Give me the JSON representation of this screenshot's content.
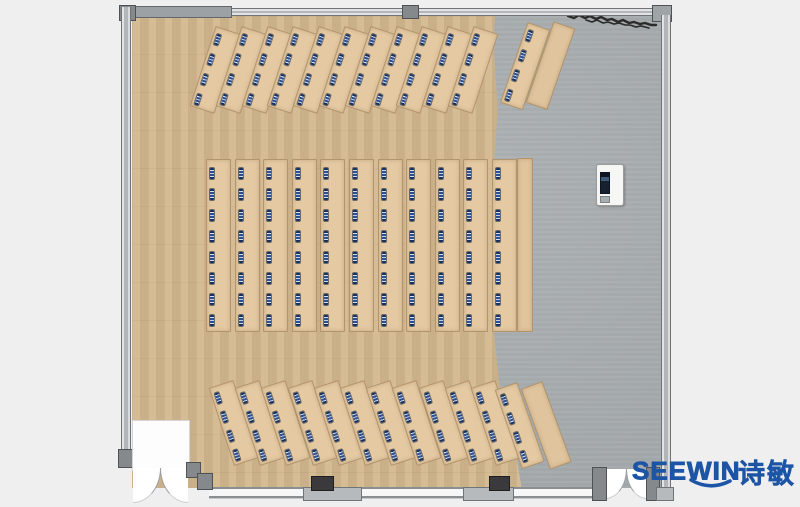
{
  "logo": {
    "text": "SEEWIN",
    "text_cn": "诗敏",
    "color": "#1d55a6"
  },
  "colors": {
    "background": "#efeff0",
    "wood_floor": "#d3b88f",
    "gray_floor": "#a9aeb1",
    "desk": "#e4c9a2",
    "seat": "#1b3a74",
    "wall": "#b5b8ba",
    "wall_dark": "#6f7476",
    "annotation": "#2b2b2b",
    "logo_blue": "#1d55a6"
  },
  "floorplan": {
    "room_type": "training-room-plan",
    "features": [
      "entrance-alcove-double-door",
      "window-wall-bottom",
      "double-door-bottom-right",
      "podium-with-screen",
      "scribble-annotation-top-right",
      "wood-floor-left",
      "gray-floor-right"
    ],
    "sections": [
      {
        "id": "front-angled-desk-rows",
        "angle_deg": 18,
        "count": 11,
        "desk": {
          "x0": 215,
          "pitch": 25.8,
          "y": 30,
          "w": 24,
          "h": 82
        },
        "seats": {
          "x": 3,
          "w": 4,
          "h": 11,
          "ys": [
            6,
            27,
            48,
            69
          ]
        },
        "side_units": [
          {
            "type": "desk",
            "x": 527,
            "y": 26,
            "w": 22,
            "h": 83,
            "angle_deg": 19
          },
          {
            "type": "counter",
            "x": 553,
            "y": 25,
            "w": 21,
            "h": 84,
            "angle_deg": 19
          }
        ]
      },
      {
        "id": "center-desk-columns",
        "angle_deg": 0,
        "count": 11,
        "desk": {
          "x0": 206,
          "pitch": 28.6,
          "y": 159,
          "w": 23,
          "h": 171
        },
        "seats": {
          "x": 3,
          "w": 4,
          "h": 11,
          "ys": [
            8,
            29,
            50,
            71,
            92,
            113,
            134,
            155
          ]
        },
        "side_units": [
          {
            "type": "counter",
            "x": 517,
            "y": 158,
            "w": 14,
            "h": 172,
            "angle_deg": 0
          }
        ]
      },
      {
        "id": "back-angled-desk-rows",
        "angle_deg": -18,
        "count": 11,
        "desk": {
          "x0": 208,
          "pitch": 26.2,
          "y": 384,
          "w": 24,
          "h": 80
        },
        "seats": {
          "x": 3,
          "w": 4,
          "h": 11,
          "ys": [
            6,
            26,
            46,
            66
          ]
        },
        "side_units": [
          {
            "type": "desk",
            "x": 494,
            "y": 386,
            "w": 22,
            "h": 82,
            "angle_deg": -19
          },
          {
            "type": "counter",
            "x": 520,
            "y": 385,
            "w": 21,
            "h": 84,
            "angle_deg": -20
          }
        ]
      }
    ]
  }
}
